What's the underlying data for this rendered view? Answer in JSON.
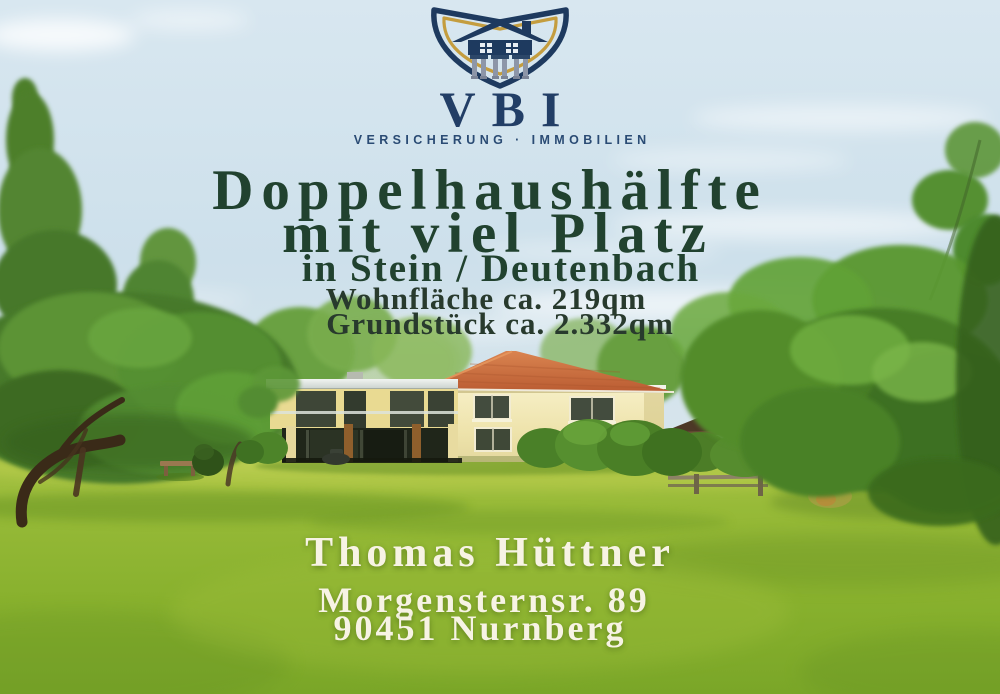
{
  "logo": {
    "brand": "VBI",
    "tagline": "VERSICHERUNG · IMMOBILIEN",
    "icon": "shield-house-pillars-icon",
    "colors": {
      "navy": "#1e3a5f",
      "gold": "#c49d3f"
    }
  },
  "headline": {
    "line1": "Doppelhaushälfte",
    "line2": "mit viel Platz",
    "location": "in Stein / Deutenbach",
    "living_area": "Wohnfläche ca. 219qm",
    "plot_area": "Grundstück ca. 2.332qm",
    "text_color": "#21422f"
  },
  "contact": {
    "name": "Thomas Hüttner",
    "street": "Morgensternsr. 89",
    "city": "90451 Nurnberg",
    "text_color": "#f7f3e4"
  },
  "scene": {
    "subject": "house-with-large-garden-photo",
    "sky_color": "#cfe0ea",
    "lawn_color": "#8cb230",
    "roof_color": "#c96f3d",
    "wall_color": "#f1e8ba"
  }
}
